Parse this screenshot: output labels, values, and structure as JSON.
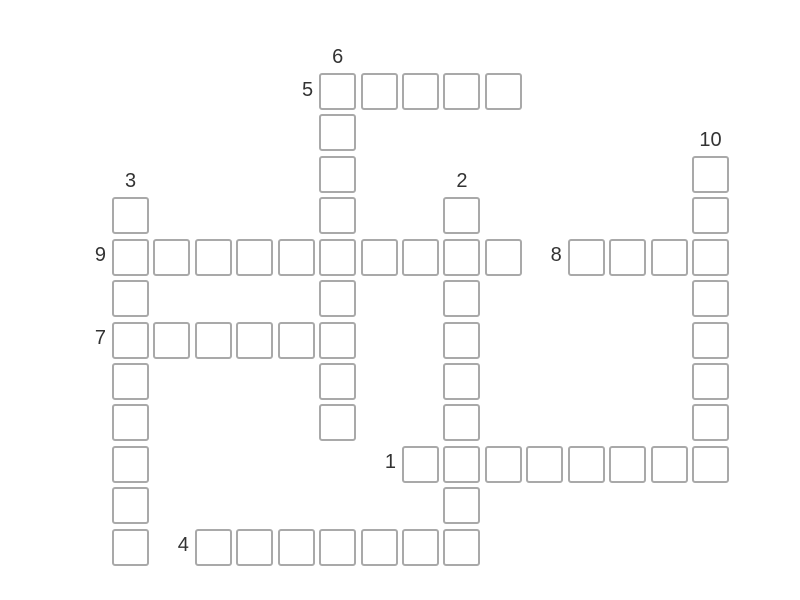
{
  "page": {
    "background_color": "#ffffff"
  },
  "puzzle": {
    "type": "crossword",
    "cell_fill_color": "#ffffff",
    "cell_border_color": "#a9a9a9",
    "label_color": "#333333",
    "grid": {
      "origin_x": 112,
      "origin_y": 73,
      "pitch": 41.43,
      "cell_size": 37
    },
    "entries": [
      {
        "number": "5",
        "direction": "across",
        "row": 0,
        "col": 5,
        "length": 5
      },
      {
        "number": "6",
        "direction": "down",
        "row": 0,
        "col": 5,
        "length": 9
      },
      {
        "number": "10",
        "direction": "down",
        "row": 2,
        "col": 14,
        "length": 8
      },
      {
        "number": "3",
        "direction": "down",
        "row": 3,
        "col": 0,
        "length": 9
      },
      {
        "number": "2",
        "direction": "down",
        "row": 3,
        "col": 8,
        "length": 9
      },
      {
        "number": "9",
        "direction": "across",
        "row": 4,
        "col": 0,
        "length": 10
      },
      {
        "number": "8",
        "direction": "across",
        "row": 4,
        "col": 11,
        "length": 4
      },
      {
        "number": "7",
        "direction": "across",
        "row": 6,
        "col": 0,
        "length": 6
      },
      {
        "number": "1",
        "direction": "across",
        "row": 9,
        "col": 7,
        "length": 8
      },
      {
        "number": "4",
        "direction": "across",
        "row": 11,
        "col": 2,
        "length": 7
      }
    ]
  }
}
